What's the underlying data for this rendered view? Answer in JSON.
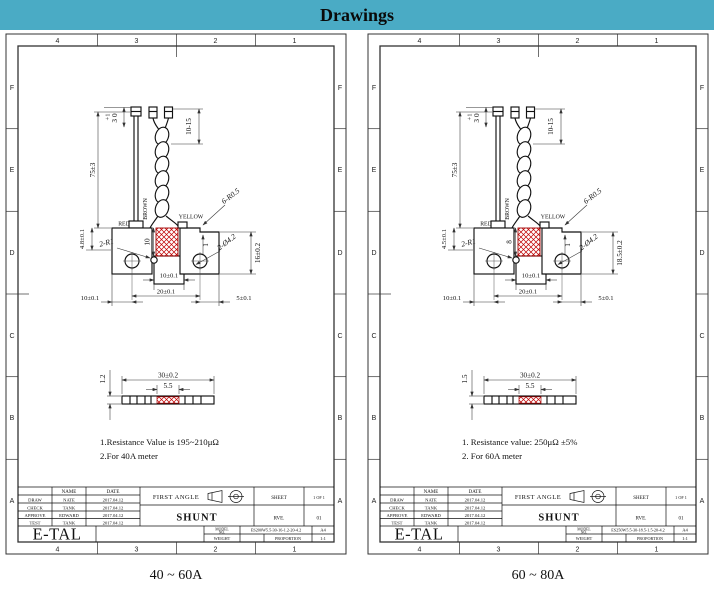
{
  "header": {
    "title": "Drawings"
  },
  "colors": {
    "header_bar": "#4aabc5",
    "hatch_red": "#c00000",
    "line": "#111111"
  },
  "sheets": [
    {
      "caption": "40 ~ 60A",
      "zones": {
        "cols": [
          "4",
          "3",
          "2",
          "1"
        ],
        "rows": [
          "F",
          "E",
          "D",
          "C",
          "B",
          "A"
        ]
      },
      "dims": {
        "wire_len": "75±3",
        "tol_plus": "+1",
        "tol_main": "30",
        "strip_range": "10-15",
        "red": "RED",
        "brown": "BROWN",
        "yellow": "YELLOW",
        "corner_radius": "6-R0.5",
        "notch_radius": "2-R1",
        "hatch_height": "10",
        "step": "1",
        "holes": "2-Ø4.2",
        "body_height": "16±0.2",
        "left_height": "4.8±0.1",
        "tab_width": "10±0.1",
        "hole_span": "20±0.1",
        "left_offset": "10±0.1",
        "right_offset": "5±0.1",
        "strip_length": "30±0.2",
        "strip_center": "5.5",
        "strip_thickness": "1.2"
      },
      "notes": [
        "1.Resistance Value is 195~210μΩ",
        "2.For 40A meter"
      ],
      "tb": {
        "name_h": "NAME",
        "date_h": "DATE",
        "rows": [
          [
            "DRAW",
            "NATE",
            "2017.04.12"
          ],
          [
            "CHECK",
            "TANK",
            "2017.04.12"
          ],
          [
            "APPROVE",
            "EDWARD",
            "2017.04.12"
          ],
          [
            "TEST",
            "TANK",
            "2017.04.12"
          ]
        ],
        "first_angle": "FIRST ANGLE",
        "sheet_label": "SHEET",
        "sheet_value": "1 OF 1",
        "title": "SHUNT",
        "rev_label": "RVE.",
        "rev_value": "01",
        "logo": "E-TAL",
        "material_label": "MATERIAL:",
        "material1": "E-Beam weldar Copper-Manganin-Copper",
        "material2": "Wire: UL1007 AWG24",
        "model_label1": "MODEL",
        "model_label2": "NO.",
        "model": "ES200W5.5-30-16-1.2-20-4.2",
        "size": "A4",
        "weight_label": "WEIGHT",
        "prop_label": "PROPORTION",
        "prop_value": "1:1"
      }
    },
    {
      "caption": "60 ~ 80A",
      "zones": {
        "cols": [
          "4",
          "3",
          "2",
          "1"
        ],
        "rows": [
          "F",
          "E",
          "D",
          "C",
          "B",
          "A"
        ]
      },
      "dims": {
        "wire_len": "75±3",
        "tol_plus": "+1",
        "tol_main": "30",
        "strip_range": "10-15",
        "red": "RED",
        "brown": "BROWN",
        "yellow": "YELLOW",
        "corner_radius": "6-R0.5",
        "notch_radius": "2-R1",
        "hatch_height": "8",
        "step": "1",
        "holes": "2-Ø4.2",
        "body_height": "18.5±0.2",
        "left_height": "4.5±0.1",
        "tab_width": "10±0.1",
        "hole_span": "20±0.1",
        "left_offset": "10±0.1",
        "right_offset": "5±0.1",
        "strip_length": "30±0.2",
        "strip_center": "5.5",
        "strip_thickness": "1.5"
      },
      "notes": [
        "1. Resistance value: 250μΩ ±5%",
        "2. For 60A meter"
      ],
      "tb": {
        "name_h": "NAME",
        "date_h": "DATE",
        "rows": [
          [
            "DRAW",
            "NATE",
            "2017.04.12"
          ],
          [
            "CHECK",
            "TANK",
            "2017.04.12"
          ],
          [
            "APPROVE",
            "EDWARD",
            "2017.04.12"
          ],
          [
            "TEST",
            "TANK",
            "2017.04.12"
          ]
        ],
        "first_angle": "FIRST ANGLE",
        "sheet_label": "SHEET",
        "sheet_value": "1 OF 1",
        "title": "SHUNT",
        "rev_label": "RVE.",
        "rev_value": "01",
        "logo": "E-TAL",
        "material_label": "MATERIAL:",
        "material1": "E-Beam weldar Copper-Manganin-Copper",
        "material2": "Wire: UL1007 AWG24",
        "model_label1": "MODEL",
        "model_label2": "NO.",
        "model": "ES250W5.5-30-18.5-1.5-20-4.2",
        "size": "A4",
        "weight_label": "WEIGHT",
        "prop_label": "PROPORTION",
        "prop_value": "1:1"
      }
    }
  ]
}
